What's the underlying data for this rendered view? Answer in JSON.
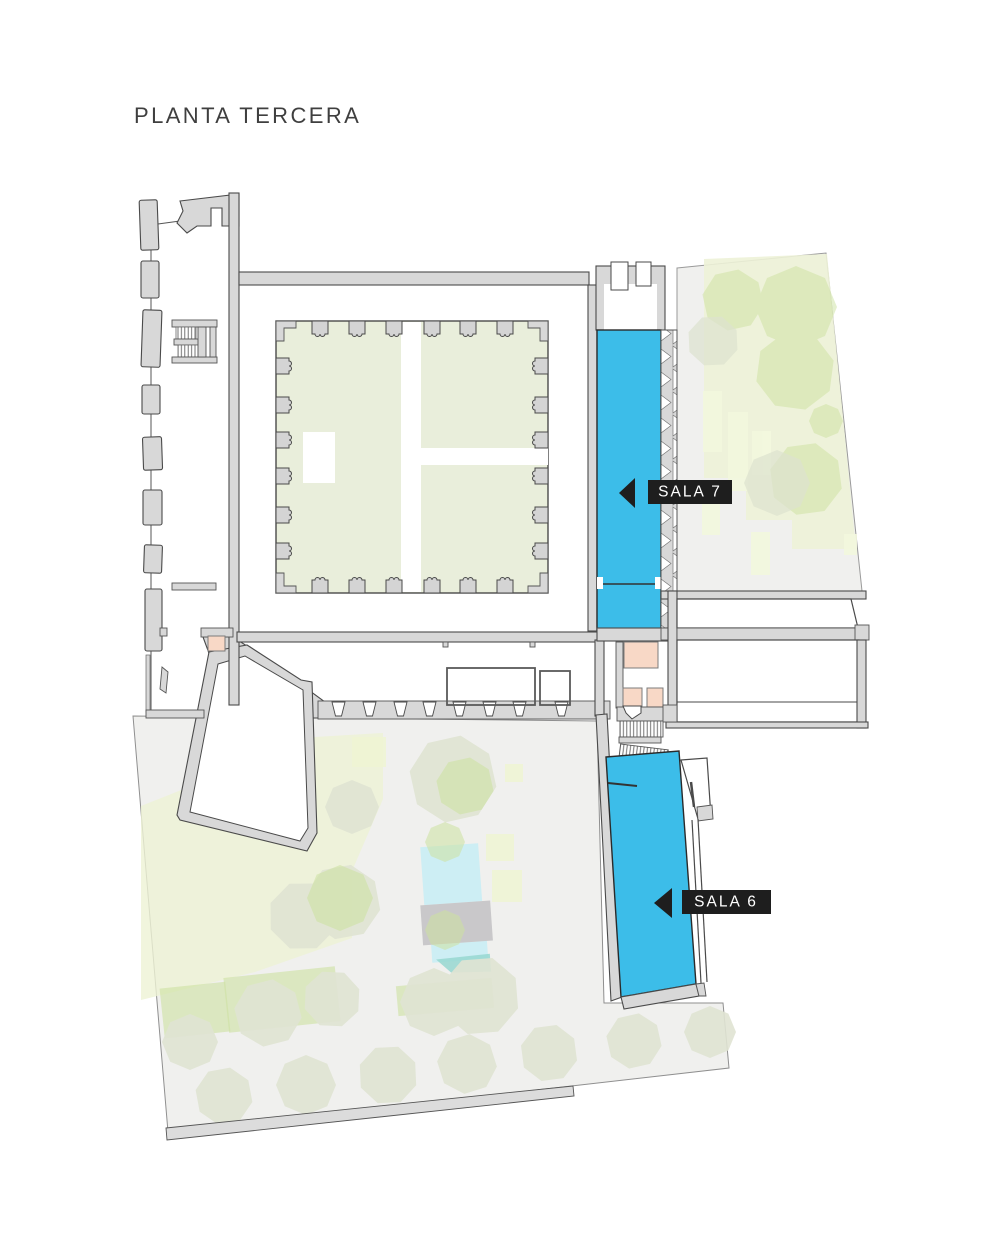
{
  "header": {
    "title": "PLANTA TERCERA"
  },
  "rooms": [
    {
      "id": "sala-7",
      "label": "SALA 7",
      "highlighted": true
    },
    {
      "id": "sala-6",
      "label": "SALA 6",
      "highlighted": true
    }
  ],
  "colors": {
    "room_highlight": "#3cbde9",
    "label_bg": "#1e1e1e",
    "label_text": "#ffffff",
    "courtyard_green": "#e9eedb",
    "garden_green_overlay": "#edf2d7",
    "tree_green": "#cde2a0",
    "tree_olive": "#e0e4d3",
    "garden_gray": "#f0f0ee",
    "wall_fill": "#d8d8d8",
    "wall_stroke": "#4a4a4a",
    "pool_blue": "#cdeef4",
    "pool_teal": "#97d7d0",
    "terrace_gray": "#c9c8ca",
    "service_pink": "#f8d8c6",
    "title_color": "#3f3f3f"
  }
}
